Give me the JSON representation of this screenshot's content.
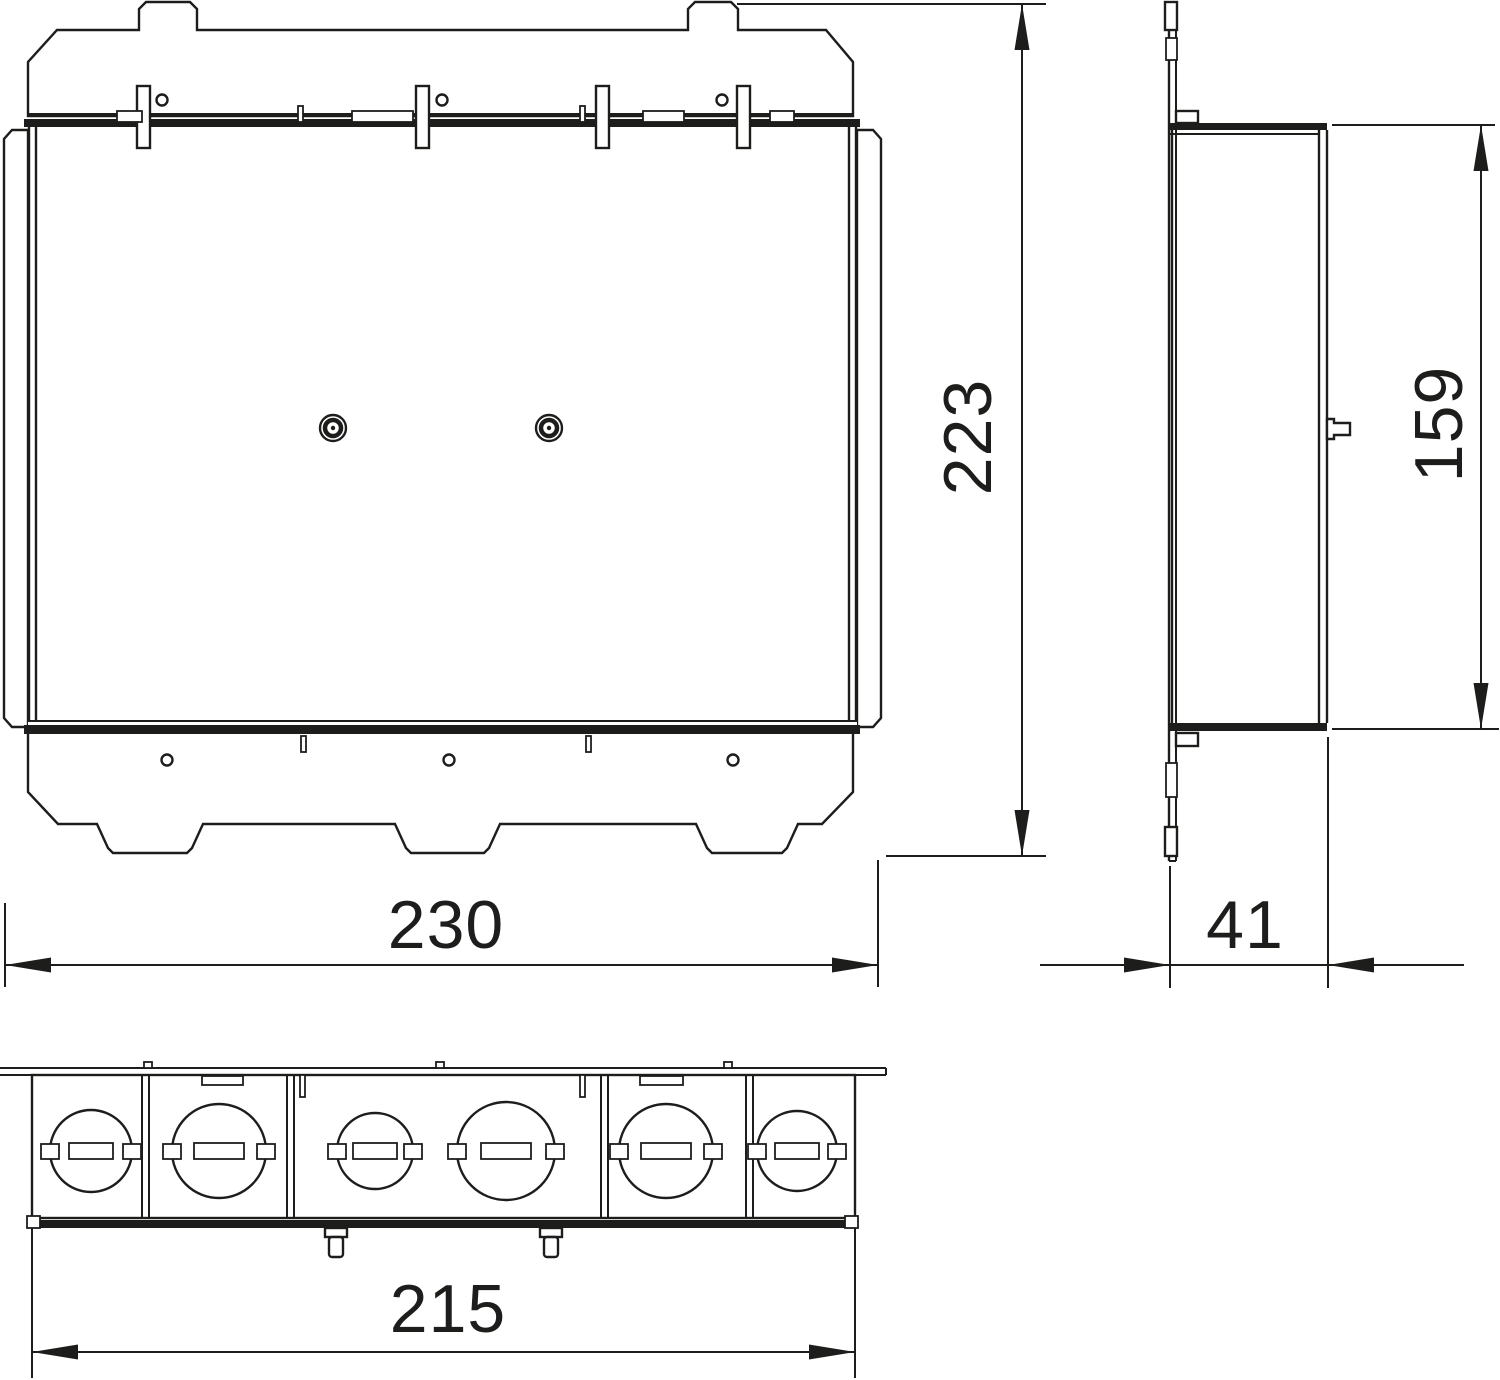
{
  "dimensions": {
    "front_width": {
      "value": "230"
    },
    "front_height": {
      "value": "223"
    },
    "side_width": {
      "value": "41"
    },
    "side_height": {
      "value": "159"
    },
    "bottom_width": {
      "value": "215"
    }
  },
  "features": {
    "knockout_count": 6,
    "cover_screw_count": 2,
    "flange_hole_count_top": 3,
    "flange_hole_count_bottom": 3,
    "foot_tab_count": 3
  },
  "colors": {
    "line": "#1d1d1b",
    "background": "#ffffff"
  }
}
